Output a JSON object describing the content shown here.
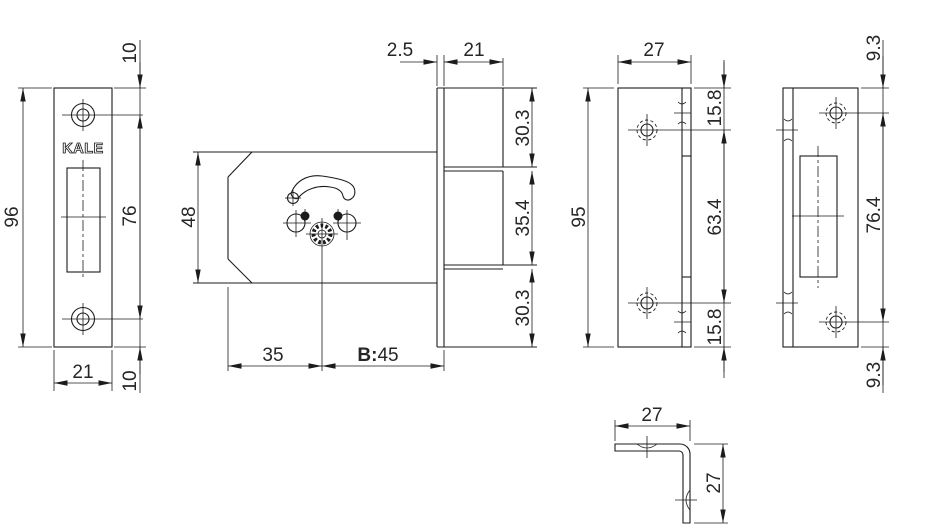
{
  "brand": "KALE",
  "views": {
    "faceplate": {
      "height": "96",
      "top_offset": "10",
      "hole_spacing": "76",
      "bottom_offset": "10",
      "width": "21"
    },
    "body": {
      "height": "48",
      "backset": "35",
      "b_prefix": "B:",
      "b_value": "45",
      "plate_thickness": "2.5",
      "case_depth": "21",
      "upper_section": "30.3",
      "middle_section": "35.4",
      "lower_section": "30.3"
    },
    "cover_plate": {
      "width": "27",
      "height": "95",
      "top_hole_offset": "15.8",
      "hole_spacing": "63.4",
      "bottom_hole_offset": "15.8"
    },
    "strike_plate": {
      "top_hole_offset": "9.3",
      "hole_spacing": "76.4",
      "bottom_hole_offset": "9.3"
    },
    "bracket": {
      "width": "27",
      "height": "27"
    }
  }
}
